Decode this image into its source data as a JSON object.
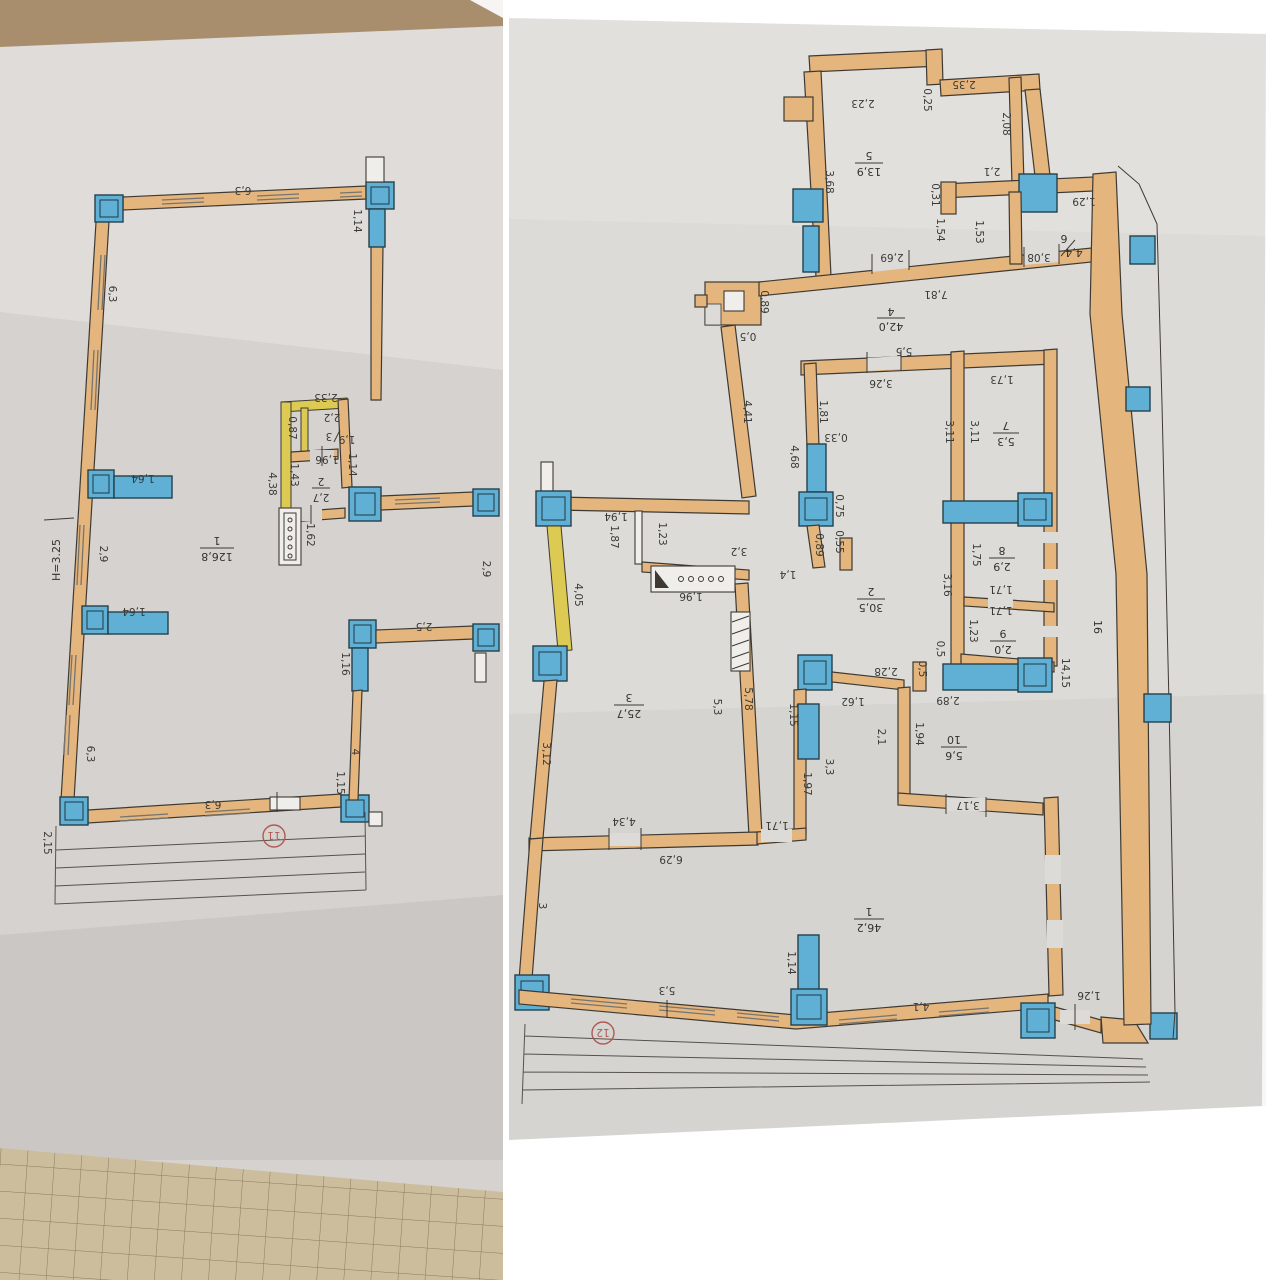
{
  "meta": {
    "description": "Two photographed architectural floor plans (technical passport sheets), drawings rotated 180 degrees on the pages",
    "left_sheet_mark": "11",
    "right_sheet_mark": "12"
  },
  "colors": {
    "wall_orange": "#e5b57e",
    "column_window_blue": "#5fb0d4",
    "yellow_wall": "#dcca52",
    "red_mark": "#b05a52",
    "paper_left": "#d6d2cf",
    "paper_right": "#dcdbd7",
    "tan_table_strip": "#a98e6d",
    "graph_paper": "#ccbd9c",
    "line_dark": "#3e3a33"
  },
  "left_plan": {
    "height_note": "H=3.25",
    "circle_label": "11",
    "room_area_total": "126,8",
    "labels": [
      "6,3",
      "1,14",
      "6,3",
      "2,33",
      "0,87",
      "2,2",
      "3",
      "1,9",
      "1,96",
      "1,14",
      "1,43",
      "2",
      "2,7",
      "4,38",
      "1,62",
      "1",
      "126,8",
      "2,9",
      "1,64",
      "1,64",
      "2,9",
      "2,5",
      "1,16",
      "4",
      "6,3",
      "1,15",
      "6,3",
      "2,15"
    ]
  },
  "right_plan": {
    "circle_label": "12",
    "labels": [
      "2,23",
      "0,25",
      "2,35",
      "2,08",
      "5",
      "13,9",
      "3,68",
      "0,31",
      "1,54",
      "2,1",
      "1,53",
      "1,29",
      "6",
      "4,4",
      "3,08",
      "2,69",
      "7,81",
      "0,89",
      "0,5",
      "4",
      "42,0",
      "4,41",
      "5,5",
      "3,26",
      "1,81",
      "0,33",
      "4,68",
      "1,73",
      "3,11",
      "3,11",
      "7",
      "5,3",
      "1,94",
      "1,87",
      "1,23",
      "4,05",
      "3,2",
      "1,4",
      "0,75",
      "0,55",
      "0,89",
      "1,96",
      "2",
      "30,5",
      "1,75",
      "8",
      "2,9",
      "1,71",
      "3,16",
      "1,71",
      "1,23",
      "9",
      "2,0",
      "0,5",
      "0,5",
      "16",
      "14,15",
      "2,28",
      "1,62",
      "1,15",
      "2,1",
      "1,94",
      "2,89",
      "10",
      "5,6",
      "3,17",
      "3,3",
      "1,97",
      "1,71",
      "5,3",
      "5,78",
      "3",
      "25,7",
      "3,12",
      "4,34",
      "6,29",
      "3",
      "1",
      "46,2",
      "1,14",
      "5,3",
      "4,1",
      "1,26"
    ]
  }
}
